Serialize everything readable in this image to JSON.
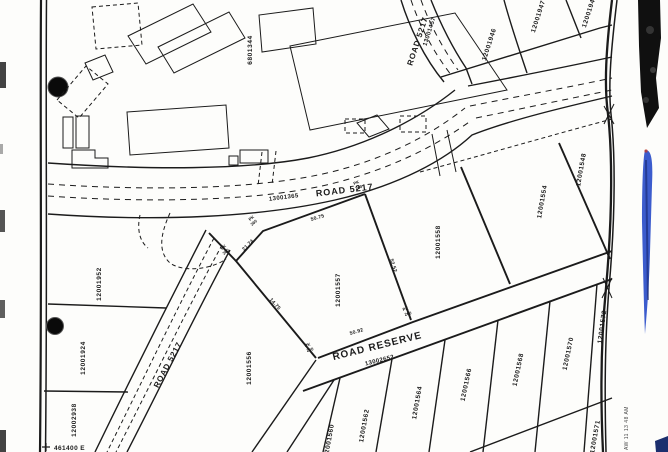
{
  "map": {
    "roads": {
      "main": {
        "id": "13001365",
        "name": "ROAD 5217"
      },
      "branch": {
        "id": "13001457",
        "name": "ROAD 5217"
      },
      "southwest": {
        "name": "ROAD 5217"
      },
      "reserve": {
        "name": "ROAD RESERVE",
        "id": "13002652"
      }
    },
    "parcels": [
      "6801344",
      "12001946",
      "12001947",
      "12001948",
      "12001952",
      "12001924",
      "12002938",
      "12001556",
      "12001557",
      "12001558",
      "12001554",
      "12001548",
      "12001560",
      "12001562",
      "12001564",
      "12001566",
      "12001568",
      "12001570",
      "12001572",
      "12001571"
    ],
    "measurements": [
      "50.75",
      "21.74",
      "52.52",
      "14.75",
      "50.92"
    ],
    "peg": {
      "label": "PK",
      "number": "260"
    },
    "grid_label": "461400 E",
    "edge_note": "AW 11 13 48 AM"
  },
  "colors": {
    "ink": "#1b1b1b",
    "paper": "#fdfdfb",
    "blue_strip": "#2b4ec9",
    "black_strip": "#101010"
  }
}
